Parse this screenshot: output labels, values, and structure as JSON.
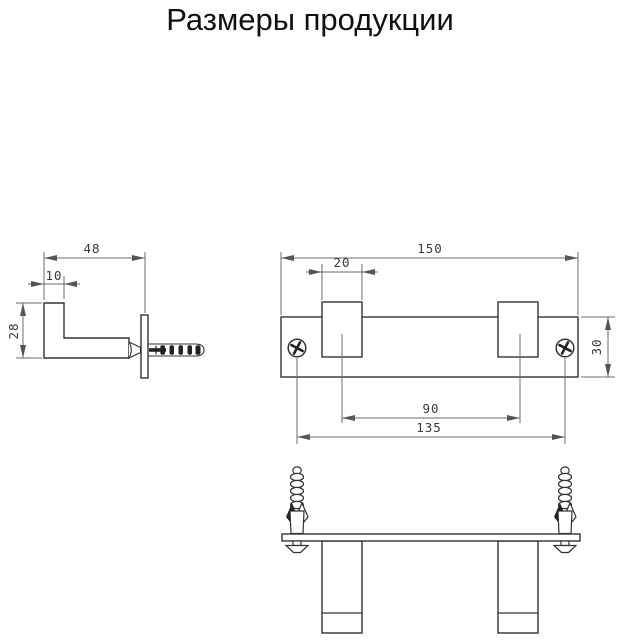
{
  "title": "Размеры продукции",
  "colors": {
    "outline": "#333333",
    "dimension_lines": "#6b6b6b",
    "text": "#1a1a1a",
    "background": "#ffffff"
  },
  "side_view": {
    "dim_depth": "48",
    "dim_hook_thickness": "10",
    "dim_hook_height": "28"
  },
  "front_view": {
    "dim_overall_width": "150",
    "dim_hook_width": "20",
    "dim_plate_height": "30",
    "dim_hook_spacing": "90",
    "dim_hole_spacing": "135"
  }
}
